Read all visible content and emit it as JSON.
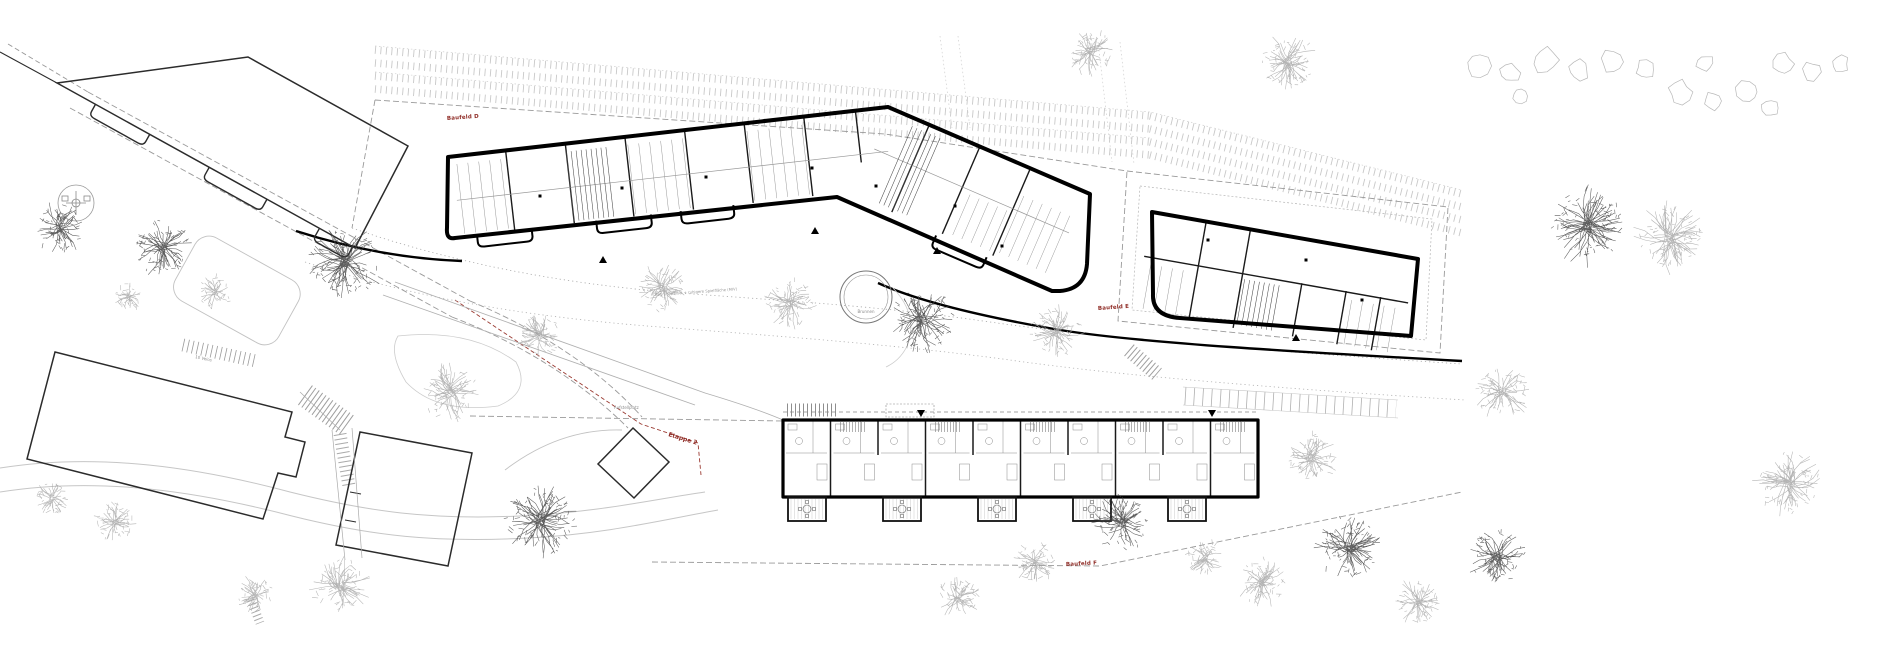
{
  "drawing": {
    "labels": {
      "baufeld_d": "Baufeld D",
      "baufeld_e": "Baufeld E",
      "baufeld_f": "Baufeld F",
      "etappe_2": "Etappe 2",
      "brunnen": "Brunnen",
      "green_island_note": "Begrünte Insel + ruhigere Spielfläche (MIV)",
      "aufstellplatz": "Aufstellplatz",
      "velo_parking": "10 Velos"
    },
    "colors": {
      "background": "#ffffff",
      "wall": "#000000",
      "existing_building": "#2b2b2b",
      "interior_line": "#8a8a8a",
      "label_red": "#8f2c26",
      "label_grey": "#8a8a8a",
      "tree_dark": "#3f3f3f",
      "tree_light": "#a7a7a7",
      "shrub": "#b8b8b8",
      "boundary_dash": "#9a9a9a",
      "railway": "#c8c8c8"
    }
  }
}
